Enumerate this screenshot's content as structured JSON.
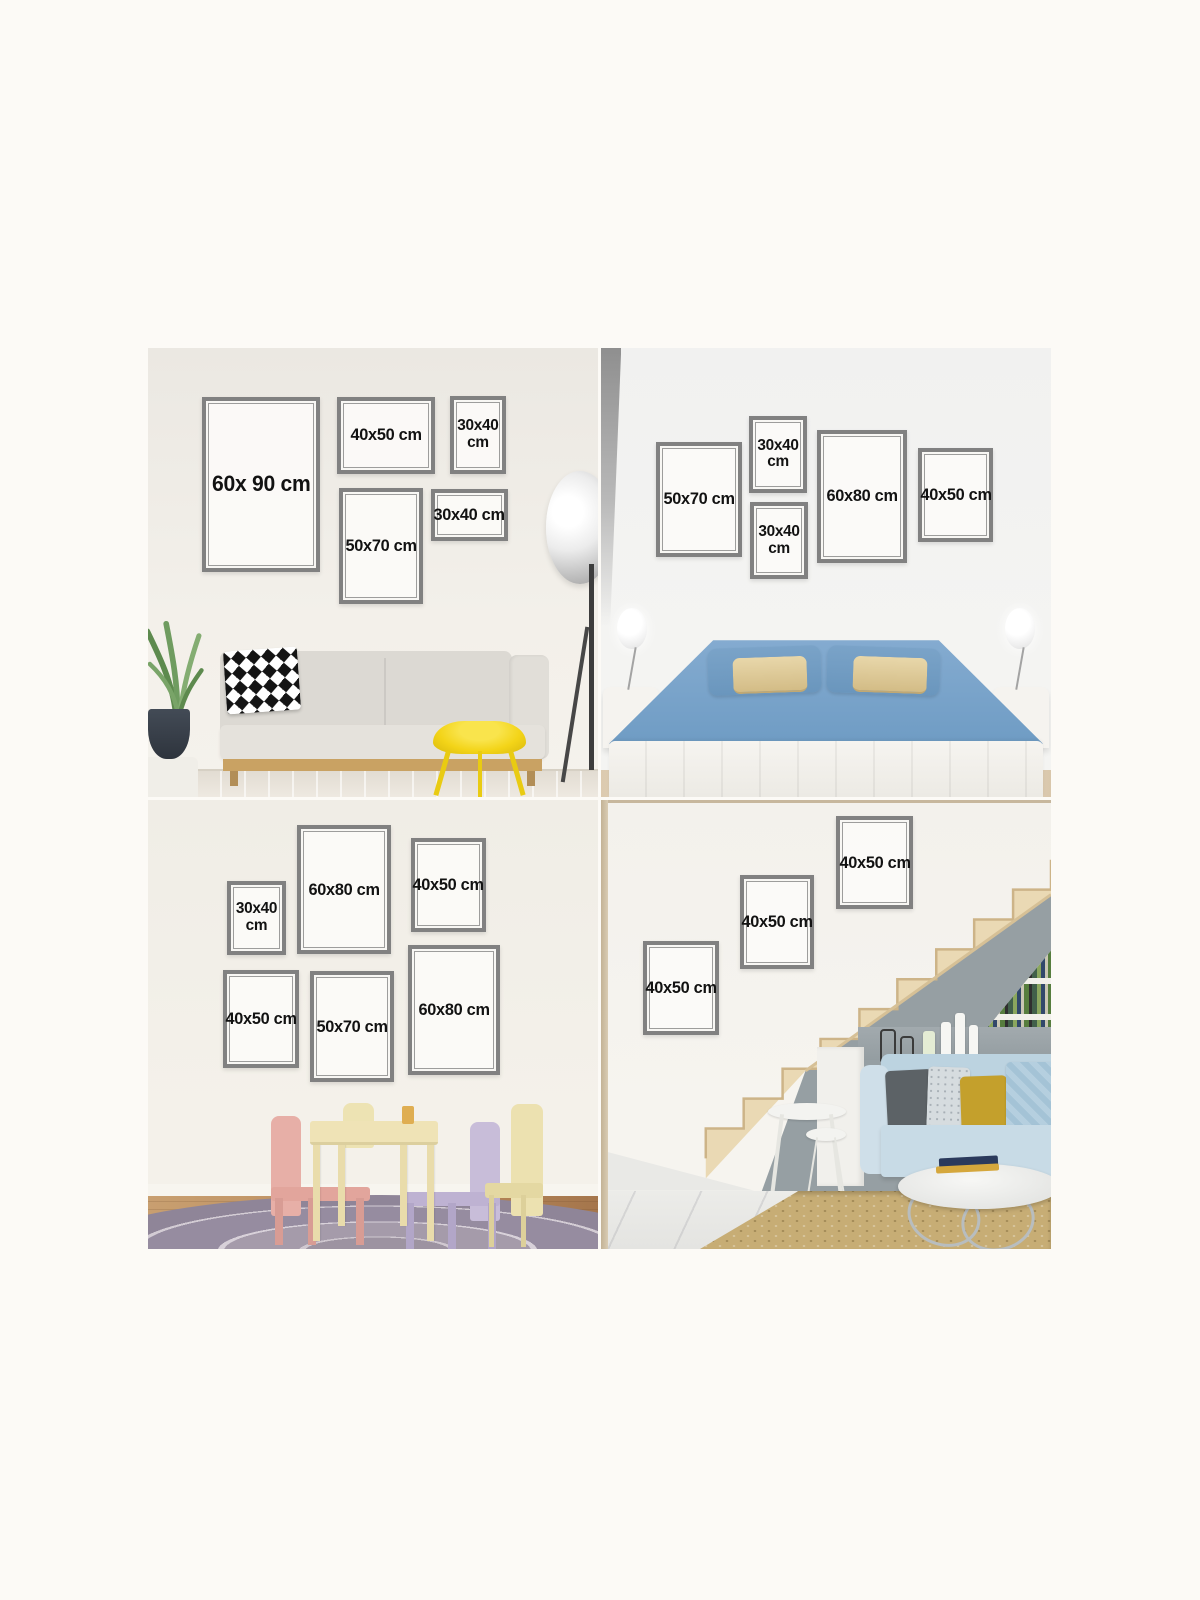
{
  "colors": {
    "page_bg": "#fcfaf6",
    "frame_border": "#818181",
    "label_ink": "#121212",
    "stool_yellow": "#f3d418",
    "bed_blue": "#84abd0",
    "sofa_blue": "#bcd3e0",
    "rug_mauve": "#9d93a1",
    "rug_tan": "#c7ad75",
    "stairs_wood": "#ead9b4",
    "mustard": "#c4a02c",
    "kids_pink": "#e7afa7",
    "kids_lavender": "#c8bdd9",
    "kids_yellow": "#ece1b0"
  },
  "quadrants": [
    {
      "id": "living-room",
      "frames": [
        {
          "label": "60x 90 cm"
        },
        {
          "label": "40x50 cm"
        },
        {
          "label": "30x40 cm"
        },
        {
          "label": "50x70 cm"
        },
        {
          "label": "30x40 cm"
        }
      ]
    },
    {
      "id": "bedroom",
      "frames": [
        {
          "label": "50x70 cm"
        },
        {
          "label": "30x40 cm"
        },
        {
          "label": "30x40 cm"
        },
        {
          "label": "60x80 cm"
        },
        {
          "label": "40x50 cm"
        }
      ]
    },
    {
      "id": "kids-room",
      "frames": [
        {
          "label": "30x40 cm"
        },
        {
          "label": "60x80 cm"
        },
        {
          "label": "40x50 cm"
        },
        {
          "label": "40x50 cm"
        },
        {
          "label": "50x70 cm"
        },
        {
          "label": "60x80 cm"
        }
      ]
    },
    {
      "id": "staircase",
      "frames": [
        {
          "label": "40x50 cm"
        },
        {
          "label": "40x50 cm"
        },
        {
          "label": "40x50 cm"
        }
      ]
    }
  ]
}
